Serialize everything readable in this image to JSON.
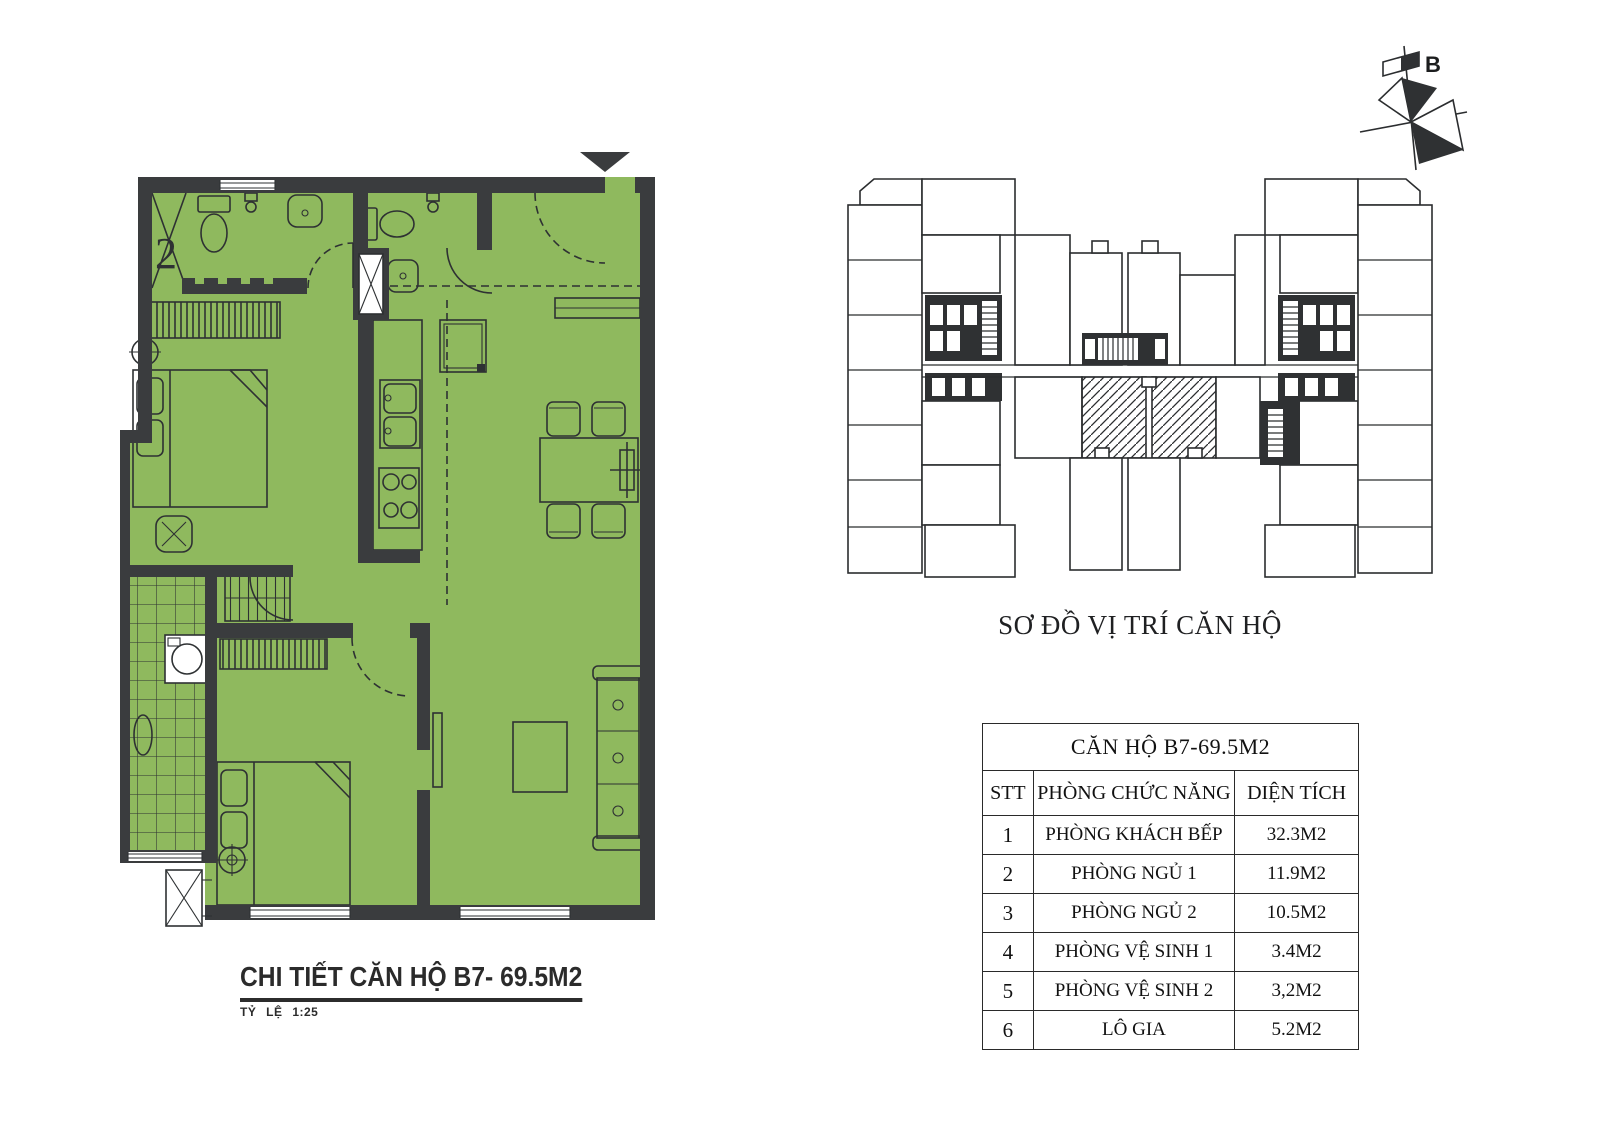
{
  "detail": {
    "title": "CHI TIẾT CĂN HỘ B7- 69.5M2",
    "scale_label": "TỶ LỆ 1:25",
    "room2_label": "2"
  },
  "overview": {
    "title": "SƠ ĐỒ VỊ TRÍ CĂN HỘ",
    "compass_label": "B"
  },
  "table": {
    "title": "CĂN HỘ B7-69.5M2",
    "headers": [
      "STT",
      "PHÒNG CHỨC NĂNG",
      "DIỆN TÍCH"
    ],
    "rows": [
      [
        "1",
        "PHÒNG KHÁCH BẾP",
        "32.3M2"
      ],
      [
        "2",
        "PHÒNG NGỦ 1",
        "11.9M2"
      ],
      [
        "3",
        "PHÒNG NGỦ 2",
        "10.5M2"
      ],
      [
        "4",
        "PHÒNG VỆ SINH 1",
        "3.4M2"
      ],
      [
        "5",
        "PHÒNG VỆ SINH 2",
        "3,2M2"
      ],
      [
        "6",
        "LÔ GIA",
        "5.2M2"
      ]
    ]
  },
  "colors": {
    "green": "#8fb95e",
    "wall": "#3a3c3e",
    "line": "#2e3133"
  }
}
